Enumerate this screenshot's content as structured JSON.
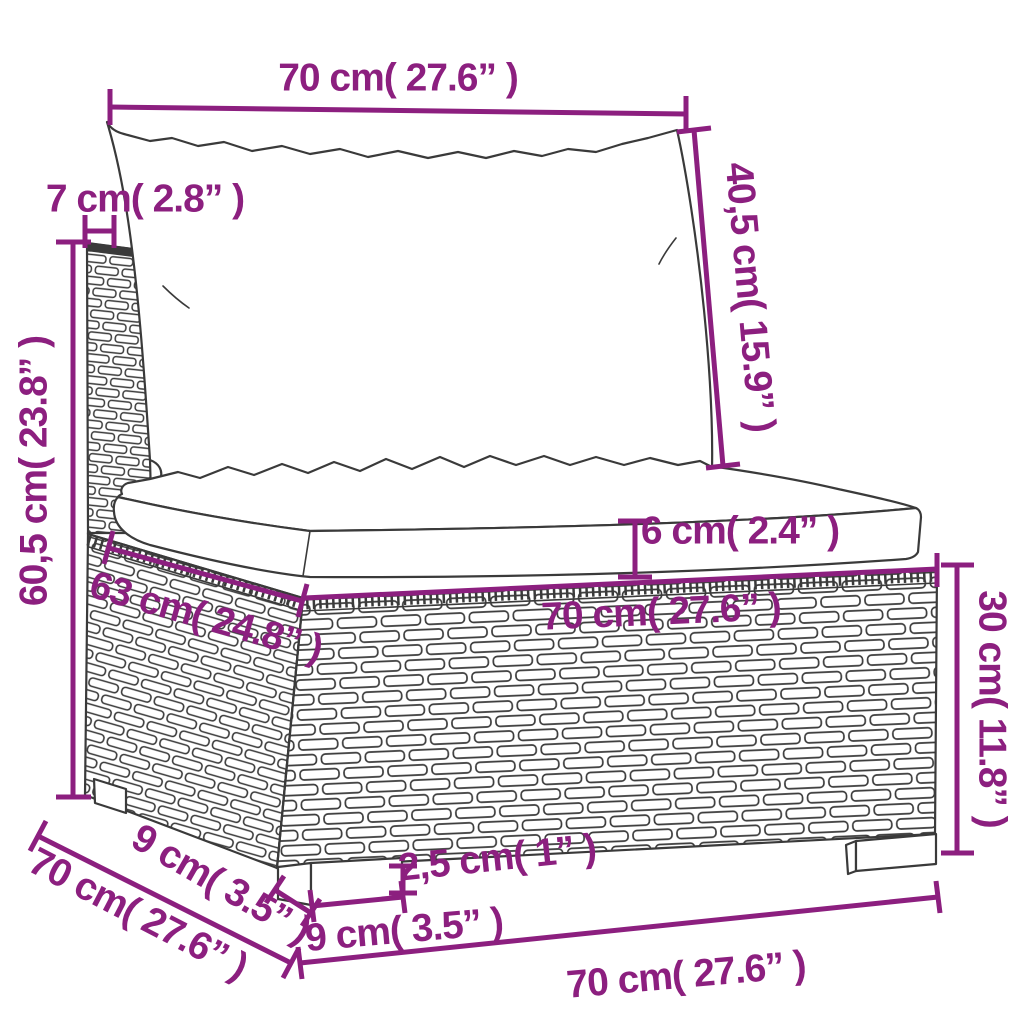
{
  "diagram": {
    "kind": "furniture-dimension-diagram",
    "subject": "rattan-sofa-middle-section-with-cushions",
    "colors": {
      "dimension_accent": "#8c1f7f",
      "drawing_outline": "#3a3a3a",
      "background": "#ffffff"
    },
    "labels": {
      "top_width": "70 cm( 27.6” )",
      "back_cushion_height": "40,5 cm( 15.9” )",
      "back_post_depth": "7 cm( 2.8” )",
      "overall_height": "60,5 cm( 23.8” )",
      "seat_depth": "63 cm( 24.8” )",
      "seat_cushion_thickness": "6 cm( 2.4” )",
      "base_top_width": "70 cm( 27.6” )",
      "base_height": "30 cm( 11.8” )",
      "bottom_depth": "70 cm( 27.6” )",
      "leg_depth": "9 cm( 3.5” )",
      "leg_width": "9 cm( 3.5” )",
      "leg_height": "2,5 cm( 1” )",
      "bottom_width": "70 cm( 27.6” )"
    }
  }
}
